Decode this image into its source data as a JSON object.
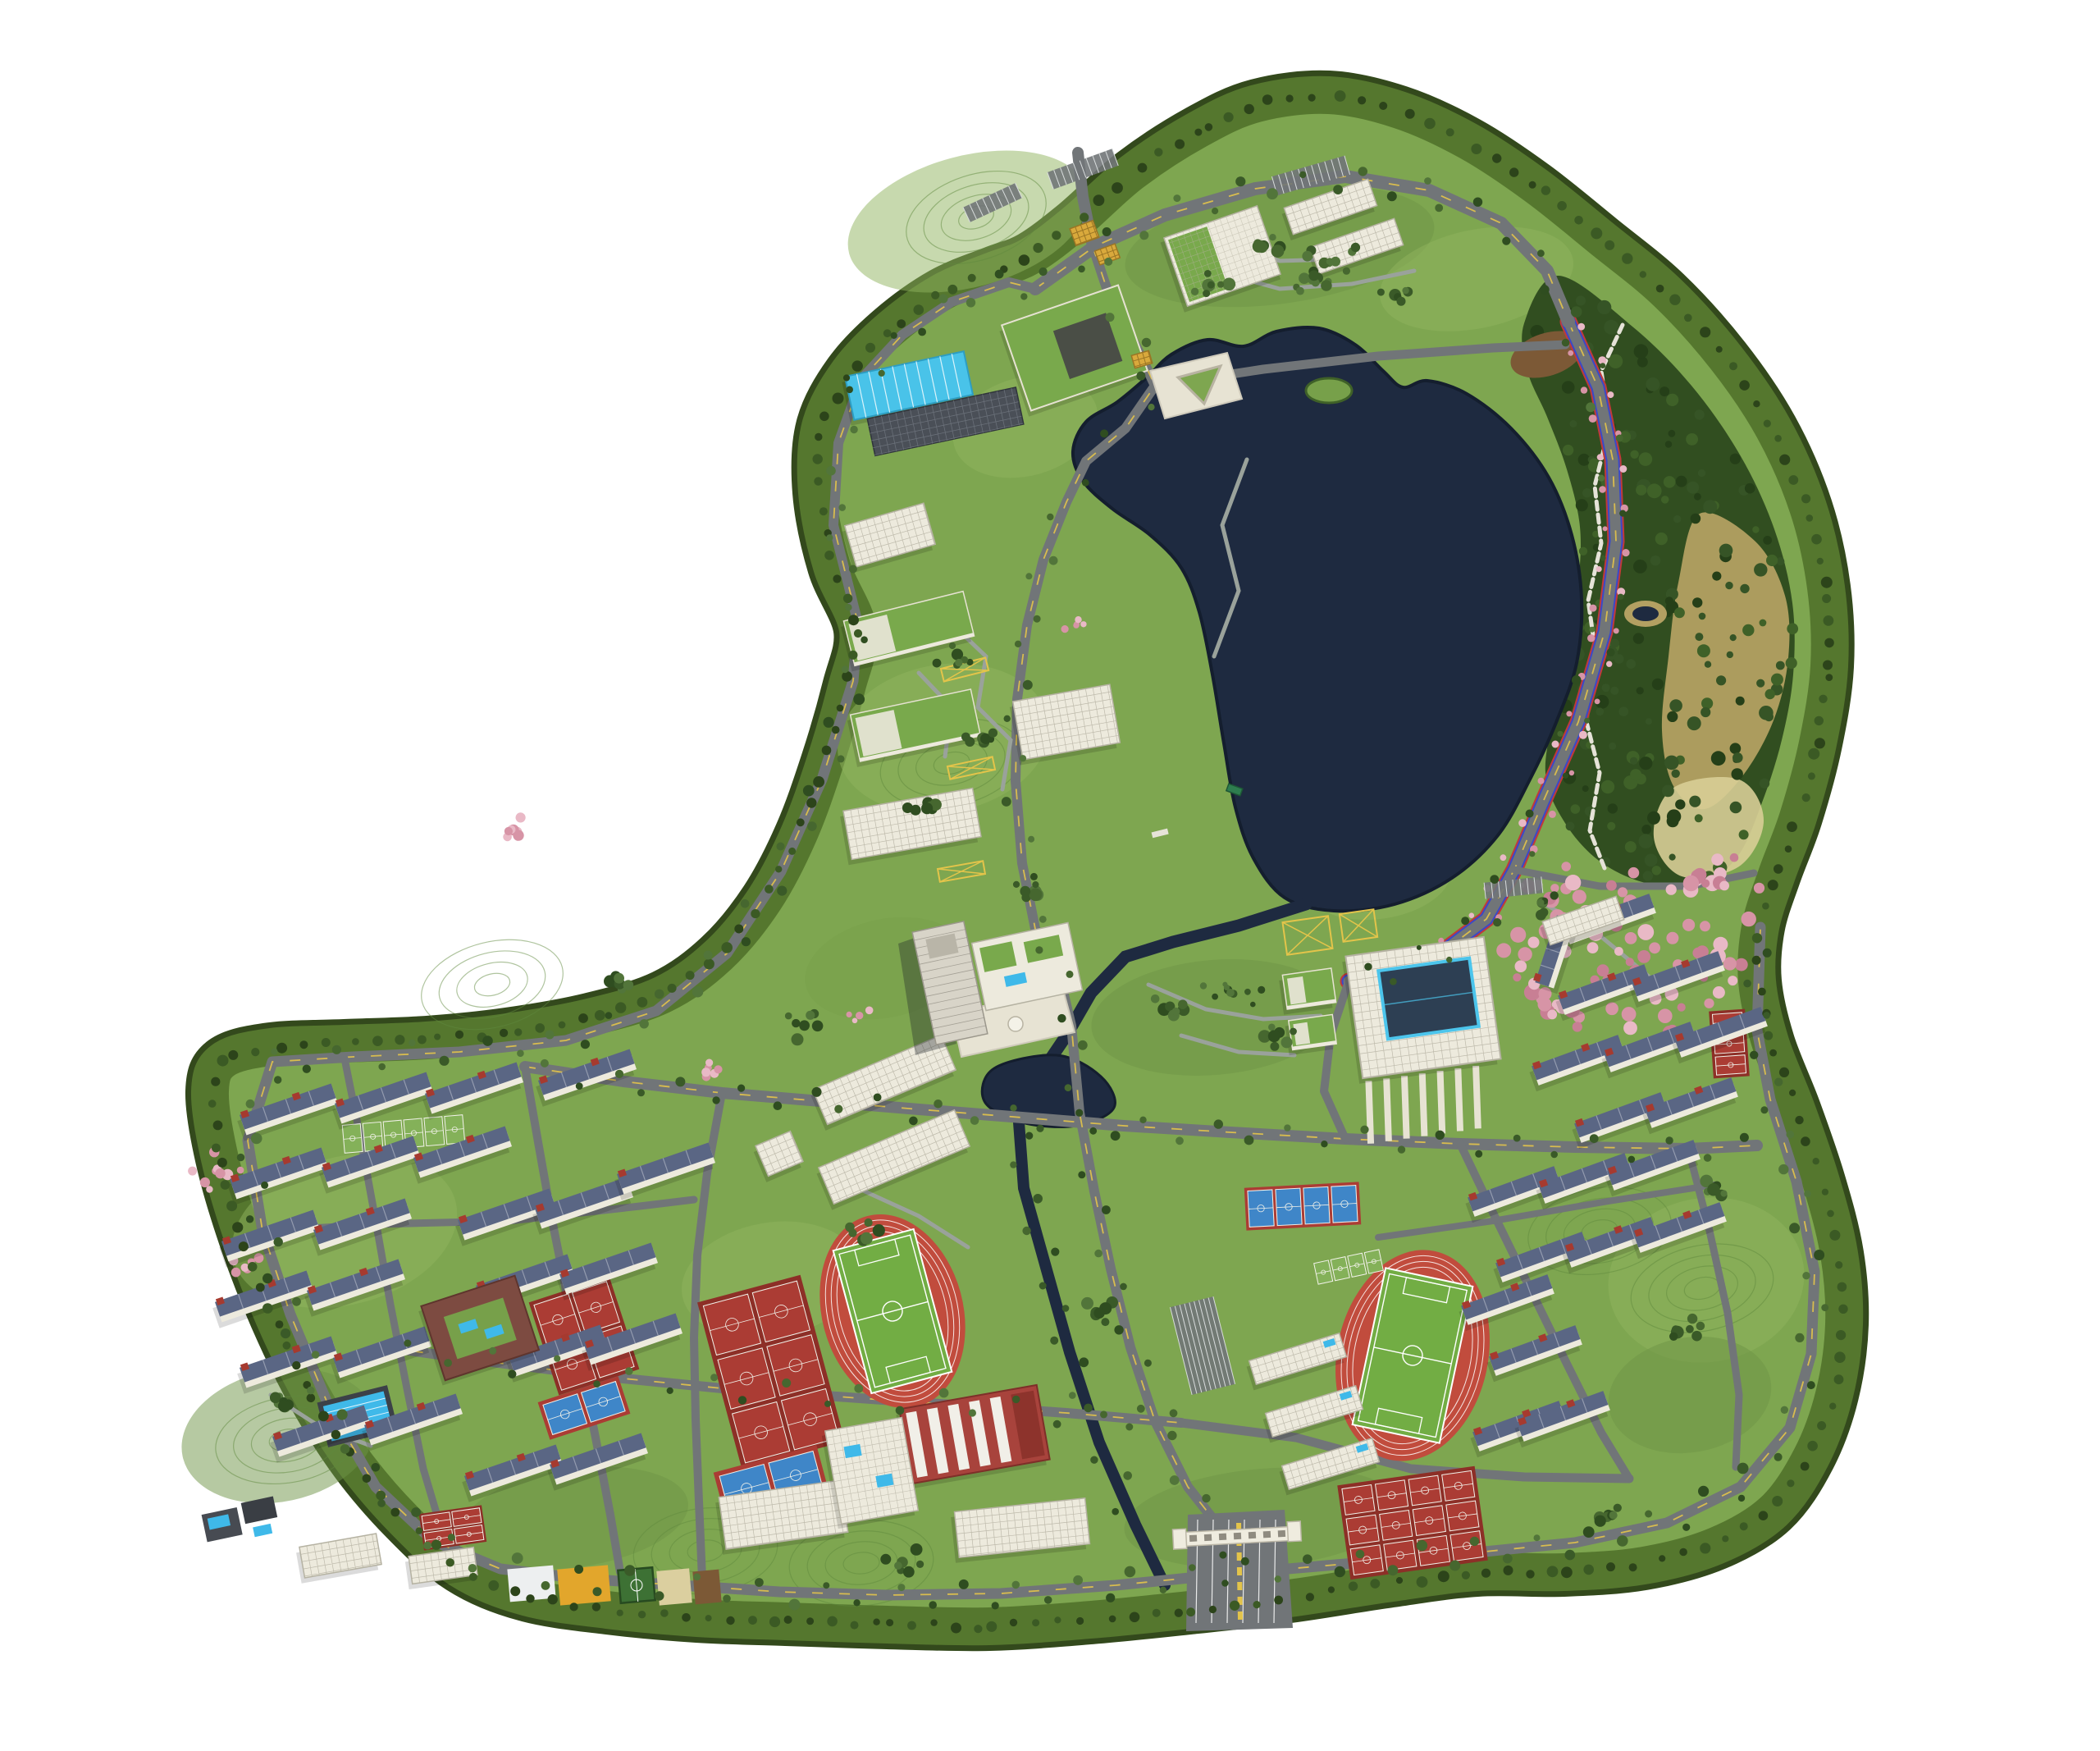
{
  "page": {
    "title": "University campus master plan - aerial 3D rendering on white background"
  },
  "map": {
    "kind": "photorealistic top-down master-plan rendering, no text or UI elements visible",
    "site_shape": "irregular boot-shaped campus parcel encircled by a dark-green tree belt, white page background",
    "features": [
      {
        "name": "central-lake",
        "type": "large dark navy lake with bays and a small green island"
      },
      {
        "name": "campus-river",
        "type": "stream from the lake through a central pond, exiting at the south gate"
      },
      {
        "name": "forest-hill",
        "type": "dense dark woodland east of the lake with tan alpine meadow, small pond and white hiking trail"
      },
      {
        "name": "cherry-blossom-grove",
        "type": "large pink flowering grove south-east of the lake, plus pink rows along the lakeside road and west edges"
      },
      {
        "name": "lakeside-ring-road",
        "type": "grey road edged with red and blue stripes and dashed yellow centerline"
      },
      {
        "name": "north-gate",
        "type": "entrance junction with yellow checker crosswalks"
      },
      {
        "name": "south-gate",
        "type": "white gate building spanning a multi-lane entrance with yellow chevron median"
      },
      {
        "name": "v-monument-plaza",
        "type": "white plaza with V-shaped monument at the head of the lake"
      },
      {
        "name": "running-track-west",
        "type": "red athletics track with green soccer pitch"
      },
      {
        "name": "running-track-east",
        "type": "red athletics track with green soccer pitch"
      },
      {
        "name": "basketball-court-clusters",
        "count": 4,
        "type": "red courts in dark-red surrounds"
      },
      {
        "name": "tennis-courts",
        "type": "blue courts in red surrounds"
      },
      {
        "name": "green-line-courts",
        "type": "light green courts marked only with white lines"
      },
      {
        "name": "outdoor-swimming-pool",
        "type": "cyan 50m pool with lane lines"
      },
      {
        "name": "natatorium",
        "type": "long hall with bright cyan striped roof near north area"
      },
      {
        "name": "gymnasium",
        "type": "hall with red and white striped roof south of west track"
      },
      {
        "name": "library-building",
        "type": "large block with dark glass atrium framed in cyan, plaza strips to the south"
      },
      {
        "name": "hotel-tower",
        "type": "tall slab tower with podium, pool deck and white plaza"
      },
      {
        "name": "academic-buildings-west-row",
        "count": 5,
        "type": "white and green-roofed slabs along west lake shore"
      },
      {
        "name": "dormitory-cluster-west",
        "count": 22,
        "type": "slab dormitories with dark blue solar roofs and red stair cores"
      },
      {
        "name": "dormitory-cluster-east",
        "count": 18,
        "type": "slab dormitories with dark blue solar roofs"
      },
      {
        "name": "canteen-courtyard-building",
        "type": "red-brown courtyard block with pools"
      },
      {
        "name": "colored-planting-fields",
        "colors": [
          "white",
          "orange",
          "fenced green court",
          "tan",
          "brown"
        ]
      },
      {
        "name": "boat-dock",
        "type": "small green-roofed boat on the south lake shore"
      },
      {
        "name": "parking-lots",
        "type": "combs of stalls and yellow cross-hatched pads"
      }
    ]
  },
  "colors": {
    "background": "#ffffff",
    "boundary_band": "#55772e",
    "boundary_edge": "#33491c",
    "campus_green": "#7ea650",
    "lawn_light": "#8fb35d",
    "lawn_dark": "#6d9445",
    "park_green": "#77a04a",
    "contour": "#5f8a3e",
    "forest": "#314e20",
    "forest_dark": "#253f18",
    "forest_light": "#3f6128",
    "meadow_tan": "#b3a062",
    "meadow_gold": "#d8ce96",
    "water": "#1e2a40",
    "water_edge": "#141e2e",
    "road": "#717578",
    "road_minor": "#85898b",
    "road_marking_yellow": "#e3c44a",
    "lane_red": "#c03a3a",
    "lane_blue": "#3a49c8",
    "path_light": "#9aa29b",
    "trail_white": "#e6e3d8",
    "plaza": "#e7e3d3",
    "building_white": "#edeadd",
    "building_grid": "#b5b2a2",
    "roof_solar": "#5a6684",
    "roof_green": "#79a94c",
    "roof_cyan": "#49c3e9",
    "glass_dark": "#2d3f53",
    "glass_frame": "#4cc5ec",
    "gym_red": "#a8433c",
    "red_cap": "#a63a2f",
    "track_red": "#c14c3d",
    "pitch_green": "#72ad44",
    "court_red": "#ab3c34",
    "court_blue": "#3f86c8",
    "court_surround": "#8d2f27",
    "court_green": "#3d7134",
    "court_light": "#84b159",
    "court_line": "#f2f2ea",
    "pool_blue": "#3fb9e9",
    "cherry_pink": "#d794a6",
    "cherry_light": "#e9b9c6",
    "field_white": "#edeff0",
    "field_orange": "#e2a62c",
    "field_tan": "#dbcf9f",
    "field_brown": "#7c5936",
    "dark_building": "#474b52",
    "shadow": "rgba(0,0,0,0.14)"
  }
}
